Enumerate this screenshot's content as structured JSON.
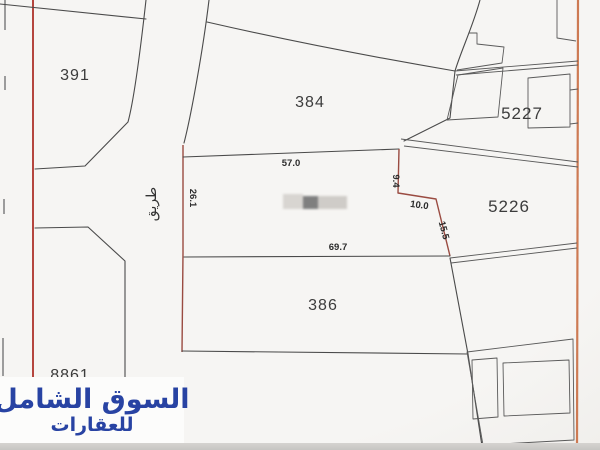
{
  "map": {
    "plots": {
      "plot_391": {
        "label": "391"
      },
      "plot_384": {
        "label": "384"
      },
      "plot_5227": {
        "label": "5227"
      },
      "plot_5226": {
        "label": "5226"
      },
      "plot_386": {
        "label": "386"
      },
      "plot_8861": {
        "label": "8861"
      }
    },
    "measurements": {
      "top": "57.0",
      "left": "26.1",
      "right_top": "9.4",
      "right_mid": "10.0",
      "right_lower": "15.5",
      "bottom": "69.7"
    },
    "road": {
      "label": "طريق"
    }
  },
  "watermark": {
    "line1": "السوق الشامل",
    "line2": "للعقارات"
  },
  "colors": {
    "map_background": "#f6f5f3",
    "plot_line": "#4a4a4a",
    "boundary_red_left": "#b5453e",
    "boundary_red_right": "#cd7a53",
    "plot_edge_maroon": "#9a4b41",
    "watermark_text_blue": "#2843a3",
    "watermark_background": "#fcfcfb",
    "redaction_dark_gray": "#7f7f7f",
    "redaction_light_gray": "#d8d5d1"
  }
}
